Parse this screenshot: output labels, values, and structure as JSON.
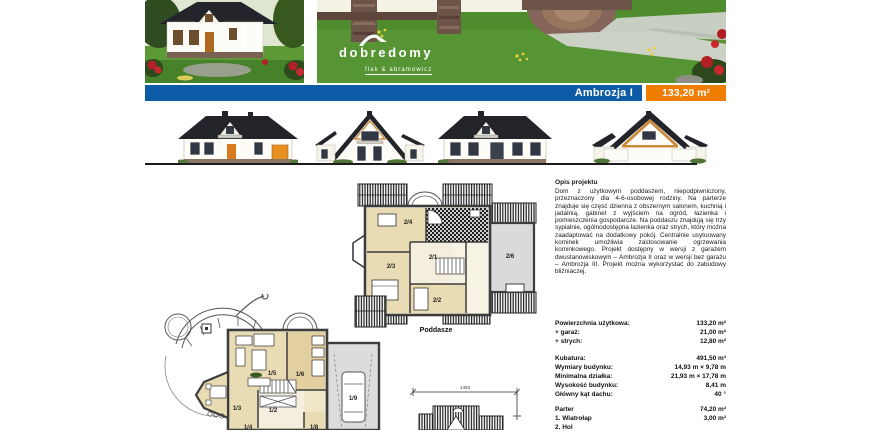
{
  "header": {
    "title": "Ambrozja I",
    "area": "133,20 m²",
    "accent_blue": "#0d5ba6",
    "accent_orange": "#ee7d00"
  },
  "logo": {
    "brand": "dobredomy",
    "sub": "flak & abramowicz"
  },
  "description": {
    "heading": "Opis projektu",
    "body": "Dom z użytkowym poddaszem, niepodpiwniczony, przeznaczony dla 4-6-osobowej rodziny. Na parterze znajduje się część dzienna z obszernym salonem, kuchnią i jadalnią, gabinet z wyjściem na ogród, łazienka i pomieszczenia gospodarcze. Na poddaszu znajdują się trzy sypialnie, ogólnodostępna łazienka oraz strych, który można zaadaptować na dodatkowy pokój. Centralnie usytuowany kominek umożliwia zastosowanie ogrzewania kominkowego. Projekt dostępny w wersji z garażem dwustanowiskowym – Ambrozja II oraz w wersji bez garażu – Ambrozja III. Projekt można wykorzystać do zabudowy bliźniaczej."
  },
  "specs": {
    "rows": [
      {
        "label": "Powierzchnia użytkowa:",
        "value": "133,20 m²"
      },
      {
        "label": "+ garaż:",
        "value": "21,00 m²"
      },
      {
        "label": "+ strych:",
        "value": "12,80 m²"
      },
      {
        "label": "Kubatura:",
        "value": "491,50 m³"
      },
      {
        "label": "Wymiary budynku:",
        "value": "14,93 m × 9,78 m"
      },
      {
        "label": "Minimalna działka:",
        "value": "21,93 m × 17,78 m"
      },
      {
        "label": "Wysokość budynku:",
        "value": "8,41 m"
      },
      {
        "label": "Główny kąt dachu:",
        "value": "40 °"
      }
    ]
  },
  "parter_table": {
    "title": "Parter",
    "title_value": "74,20 m²",
    "rows": [
      {
        "label": "1. Wiatrołap",
        "value": "3,00 m²"
      },
      {
        "label": "2. Hol",
        "value": ""
      }
    ]
  },
  "plans": {
    "poddasze_label": "Poddasze",
    "poddasze_rooms": {
      "r1": "2/1",
      "r2": "2/2",
      "r3": "2/3",
      "r4": "2/4",
      "r6": "2/6"
    },
    "parter_rooms": {
      "r2": "1/2",
      "r3": "1/3",
      "r4": "1/4",
      "r5": "1/5",
      "r6": "1/6",
      "r8": "1/8",
      "r9": "1/9"
    },
    "front_width_dim": "1493"
  }
}
